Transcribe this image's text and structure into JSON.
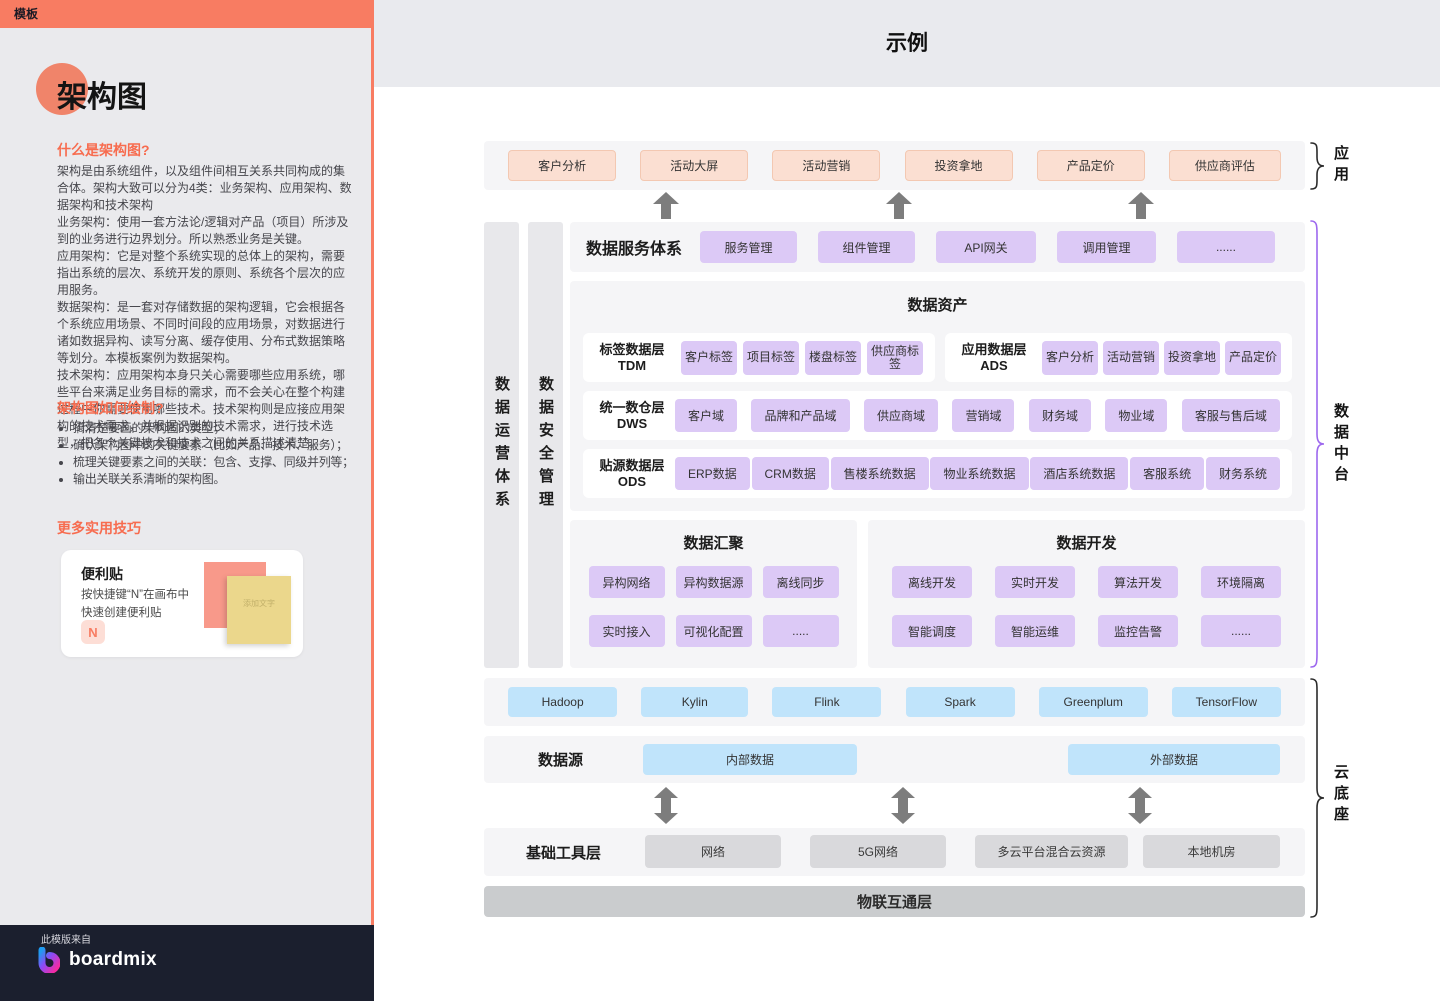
{
  "colors": {
    "accent_salmon": "#F87C62",
    "heading_orange": "#F76C4F",
    "peach_box": "#FBDFD2",
    "purple_box": "#DCC9F6",
    "blue_box": "#C0E4FB",
    "gray_box": "#D9D9DC",
    "panel_gray": "#F5F5F7",
    "brace_purple": "#9D68EE",
    "footer_dark": "#1B1F2E"
  },
  "sidebar": {
    "badge": "模板",
    "title": "架构图",
    "what": {
      "heading": "什么是架构图?",
      "body": "架构是由系统组件，以及组件间相互关系共同构成的集合体。架构大致可以分为4类：业务架构、应用架构、数据架构和技术架构\n业务架构：使用一套方法论/逻辑对产品（项目）所涉及到的业务进行边界划分。所以熟悉业务是关键。\n应用架构：它是对整个系统实现的总体上的架构，需要指出系统的层次、系统开发的原则、系统各个层次的应用服务。\n数据架构：是一套对存储数据的架构逻辑，它会根据各个系统应用场景、不同时间段的应用场景，对数据进行诸如数据异构、读写分离、缓存使用、分布式数据策略等划分。本模板案例为数据架构。\n技术架构：应用架构本身只关心需要哪些应用系统，哪些平台来满足业务目标的需求，而不会关心在整个构建过程中你需要使用哪些技术。技术架构则是应接应用架构的技术需求，并根据识别的技术需求，进行技术选型，把各个关键技术和技术之间的关系描述清楚。"
    },
    "how": {
      "heading": "架构图如何绘制?",
      "bullets": [
        "搞清楚要画的架构图的类型；",
        "确认架构图中的关键要素（比如产品、技术、服务）；",
        "梳理关键要素之间的关联：包含、支撑、同级并列等；",
        "输出关联关系清晰的架构图。"
      ]
    },
    "tips": {
      "heading": "更多实用技巧",
      "card": {
        "title": "便利贴",
        "desc": "按快捷键“N”在画布中\n快速创建便利贴",
        "key": "N",
        "sticky_placeholder": "添加文字"
      }
    },
    "footer": {
      "from": "此模版来自",
      "brand": "boardmix"
    }
  },
  "canvas": {
    "title": "示例",
    "app_layer": {
      "brace_label": "应用",
      "boxes": [
        "客户分析",
        "活动大屏",
        "活动营销",
        "投资拿地",
        "产品定价",
        "供应商评估"
      ]
    },
    "service_row": {
      "label": "数据服务体系",
      "boxes": [
        "服务管理",
        "组件管理",
        "API网关",
        "调用管理",
        "......"
      ]
    },
    "side_bars": [
      "数据运营体系",
      "数据安全管理"
    ],
    "assets": {
      "title": "数据资产",
      "tdm": {
        "name": "标签数据层",
        "code": "TDM",
        "boxes": [
          "客户标签",
          "项目标签",
          "楼盘标签",
          "供应商标签"
        ]
      },
      "ads": {
        "name": "应用数据层",
        "code": "ADS",
        "boxes": [
          "客户分析",
          "活动营销",
          "投资拿地",
          "产品定价"
        ]
      },
      "dws": {
        "name": "统一数仓层",
        "code": "DWS",
        "boxes": [
          "客户域",
          "品牌和产品域",
          "供应商域",
          "营销域",
          "财务域",
          "物业域",
          "客服与售后域"
        ]
      },
      "ods": {
        "name": "贴源数据层",
        "code": "ODS",
        "boxes": [
          "ERP数据",
          "CRM数据",
          "售楼系统数据",
          "物业系统数据",
          "酒店系统数据",
          "客服系统",
          "财务系统"
        ]
      }
    },
    "converge": {
      "title": "数据汇聚",
      "boxes": [
        "异构网络",
        "异构数据源",
        "离线同步",
        "实时接入",
        "可视化配置",
        "....."
      ]
    },
    "develop": {
      "title": "数据开发",
      "boxes": [
        "离线开发",
        "实时开发",
        "算法开发",
        "环境隔离",
        "智能调度",
        "智能运维",
        "监控告警",
        "......"
      ]
    },
    "middle_brace_label": "数据中台",
    "tech_row": [
      "Hadoop",
      "Kylin",
      "Flink",
      "Spark",
      "Greenplum",
      "TensorFlow"
    ],
    "source_row": {
      "label": "数据源",
      "boxes": [
        "内部数据",
        "外部数据"
      ]
    },
    "infra_row": {
      "label": "基础工具层",
      "boxes": [
        "网络",
        "5G网络",
        "多云平台混合云资源",
        "本地机房"
      ]
    },
    "iot_bar": "物联互通层",
    "cloud_brace_label": "云底座"
  }
}
